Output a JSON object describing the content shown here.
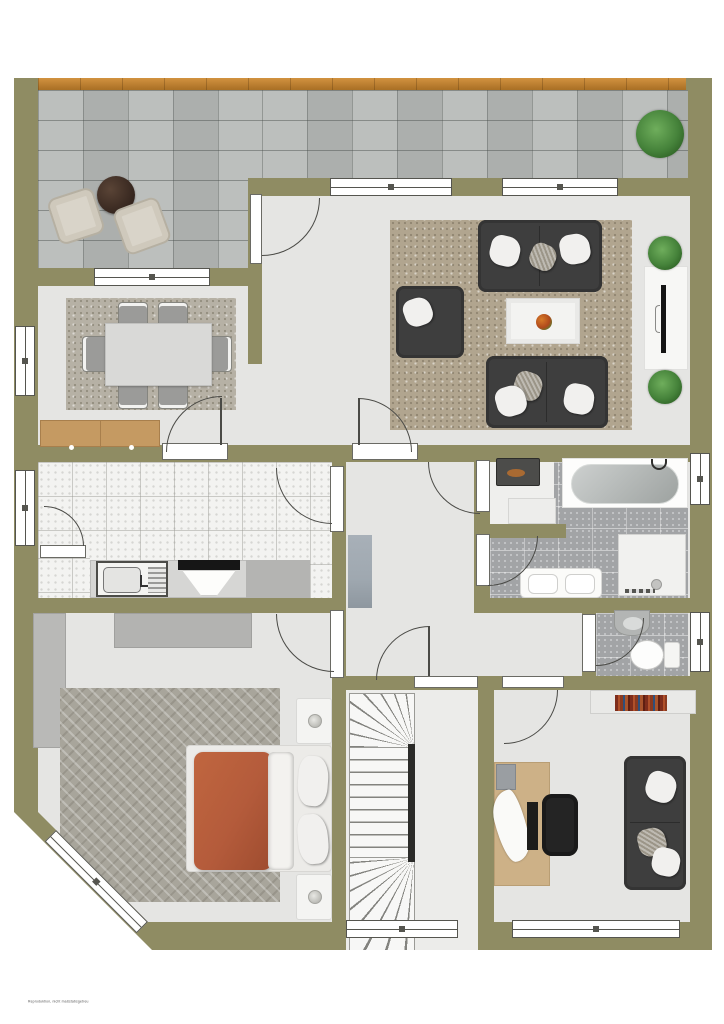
{
  "footer": {
    "watermark": "Reproduktion, nicht maßstabsgetreu"
  },
  "palette": {
    "wall": "#8f8c63",
    "floor": "#e5e5e3",
    "terrace": "#b7bab8",
    "wood": "#c08232",
    "kitchen_tile": "#f3f3f1",
    "bath_tile": "#a2a4a6",
    "rug_living": "#b1a58f",
    "rug_dining": "#b6b1a5",
    "rug_bedroom": "#a8a59b",
    "sofa": "#3e3e3e",
    "bed_duvet": "#b45b3b",
    "desk_wood": "#cdb187",
    "sideboard_wood": "#c59a62",
    "plant": "#45823a",
    "stair_rail": "#2b2b29",
    "doormat": "#9fa8b0"
  }
}
